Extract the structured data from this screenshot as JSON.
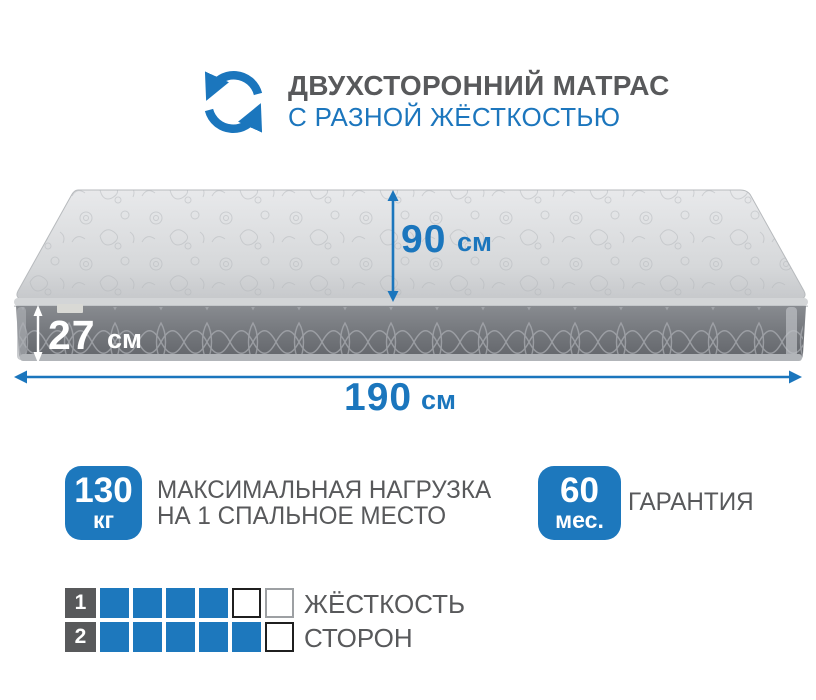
{
  "header": {
    "icon": "rotate-two-sided-icon",
    "title": "ДВУХСТОРОННИЙ МАТРАС",
    "subtitle": "С РАЗНОЙ ЖЁСТКОСТЬЮ"
  },
  "dimensions": {
    "height": {
      "value": "27",
      "unit": "см"
    },
    "width": {
      "value": "90",
      "unit": "см"
    },
    "length": {
      "value": "190",
      "unit": "см"
    }
  },
  "features": {
    "max_load": {
      "badge_value": "130",
      "badge_unit": "кг",
      "line1": "МАКСИМАЛЬНАЯ НАГРУЗКА",
      "line2": "НА 1 СПАЛЬНОЕ МЕСТО"
    },
    "warranty": {
      "badge_value": "60",
      "badge_unit": "мес.",
      "label": "ГАРАНТИЯ"
    }
  },
  "firmness": {
    "label_line1": "ЖЁСТКОСТЬ",
    "label_line2": "СТОРОН",
    "scale_max": 6,
    "rows": [
      {
        "side": "1",
        "filled": 4
      },
      {
        "side": "2",
        "filled": 5
      }
    ]
  },
  "colors": {
    "accent_blue": "#1d78bd",
    "text_gray": "#58595b",
    "mattress_top": "#d9dbdd",
    "mattress_side": "#75787d"
  }
}
